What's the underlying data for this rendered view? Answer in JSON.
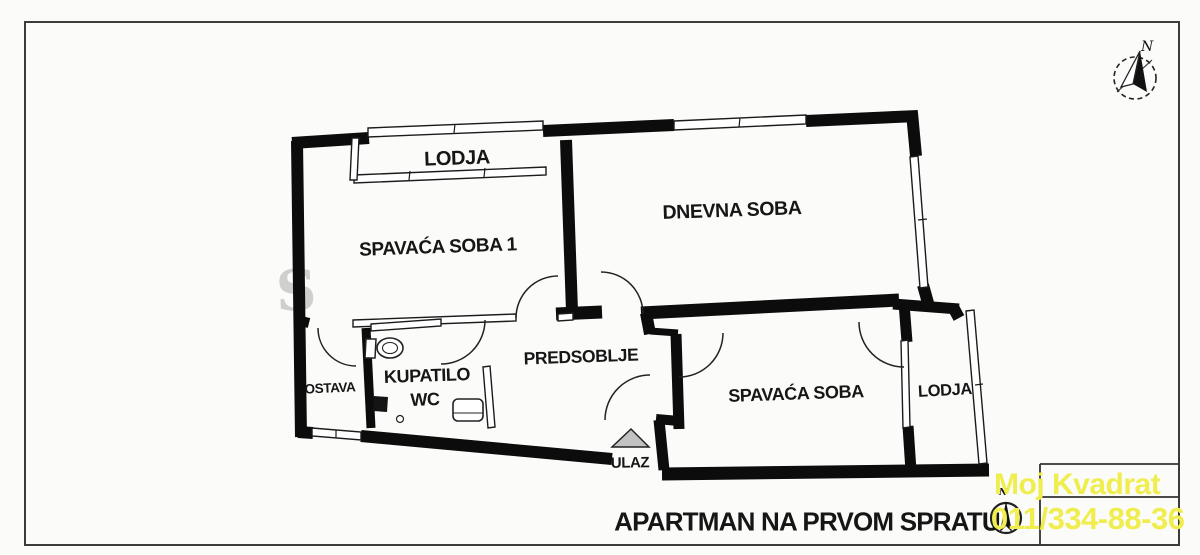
{
  "rooms": {
    "lodja_left": "LODJA",
    "spavaca_soba_1": "SPAVAĆA SOBA 1",
    "dnevna_soba": "DNEVNA SOBA",
    "ostava": "OSTAVA",
    "kupatilo_line1": "KUPATILO",
    "kupatilo_line2": "WC",
    "predsoblje": "PREDSOBLJE",
    "spavaca_soba": "SPAVAĆA SOBA",
    "lodja_right": "LODJA"
  },
  "entrance": {
    "label": "ULAZ"
  },
  "compass": {
    "north": "N"
  },
  "title": {
    "text": "APARTMAN NA PRVOM SPRATU"
  },
  "watermark": {
    "line1": "Moj Kvadrat",
    "line2": "011/334-88-36",
    "color": "#f0ed4e"
  },
  "background_mark": "S"
}
